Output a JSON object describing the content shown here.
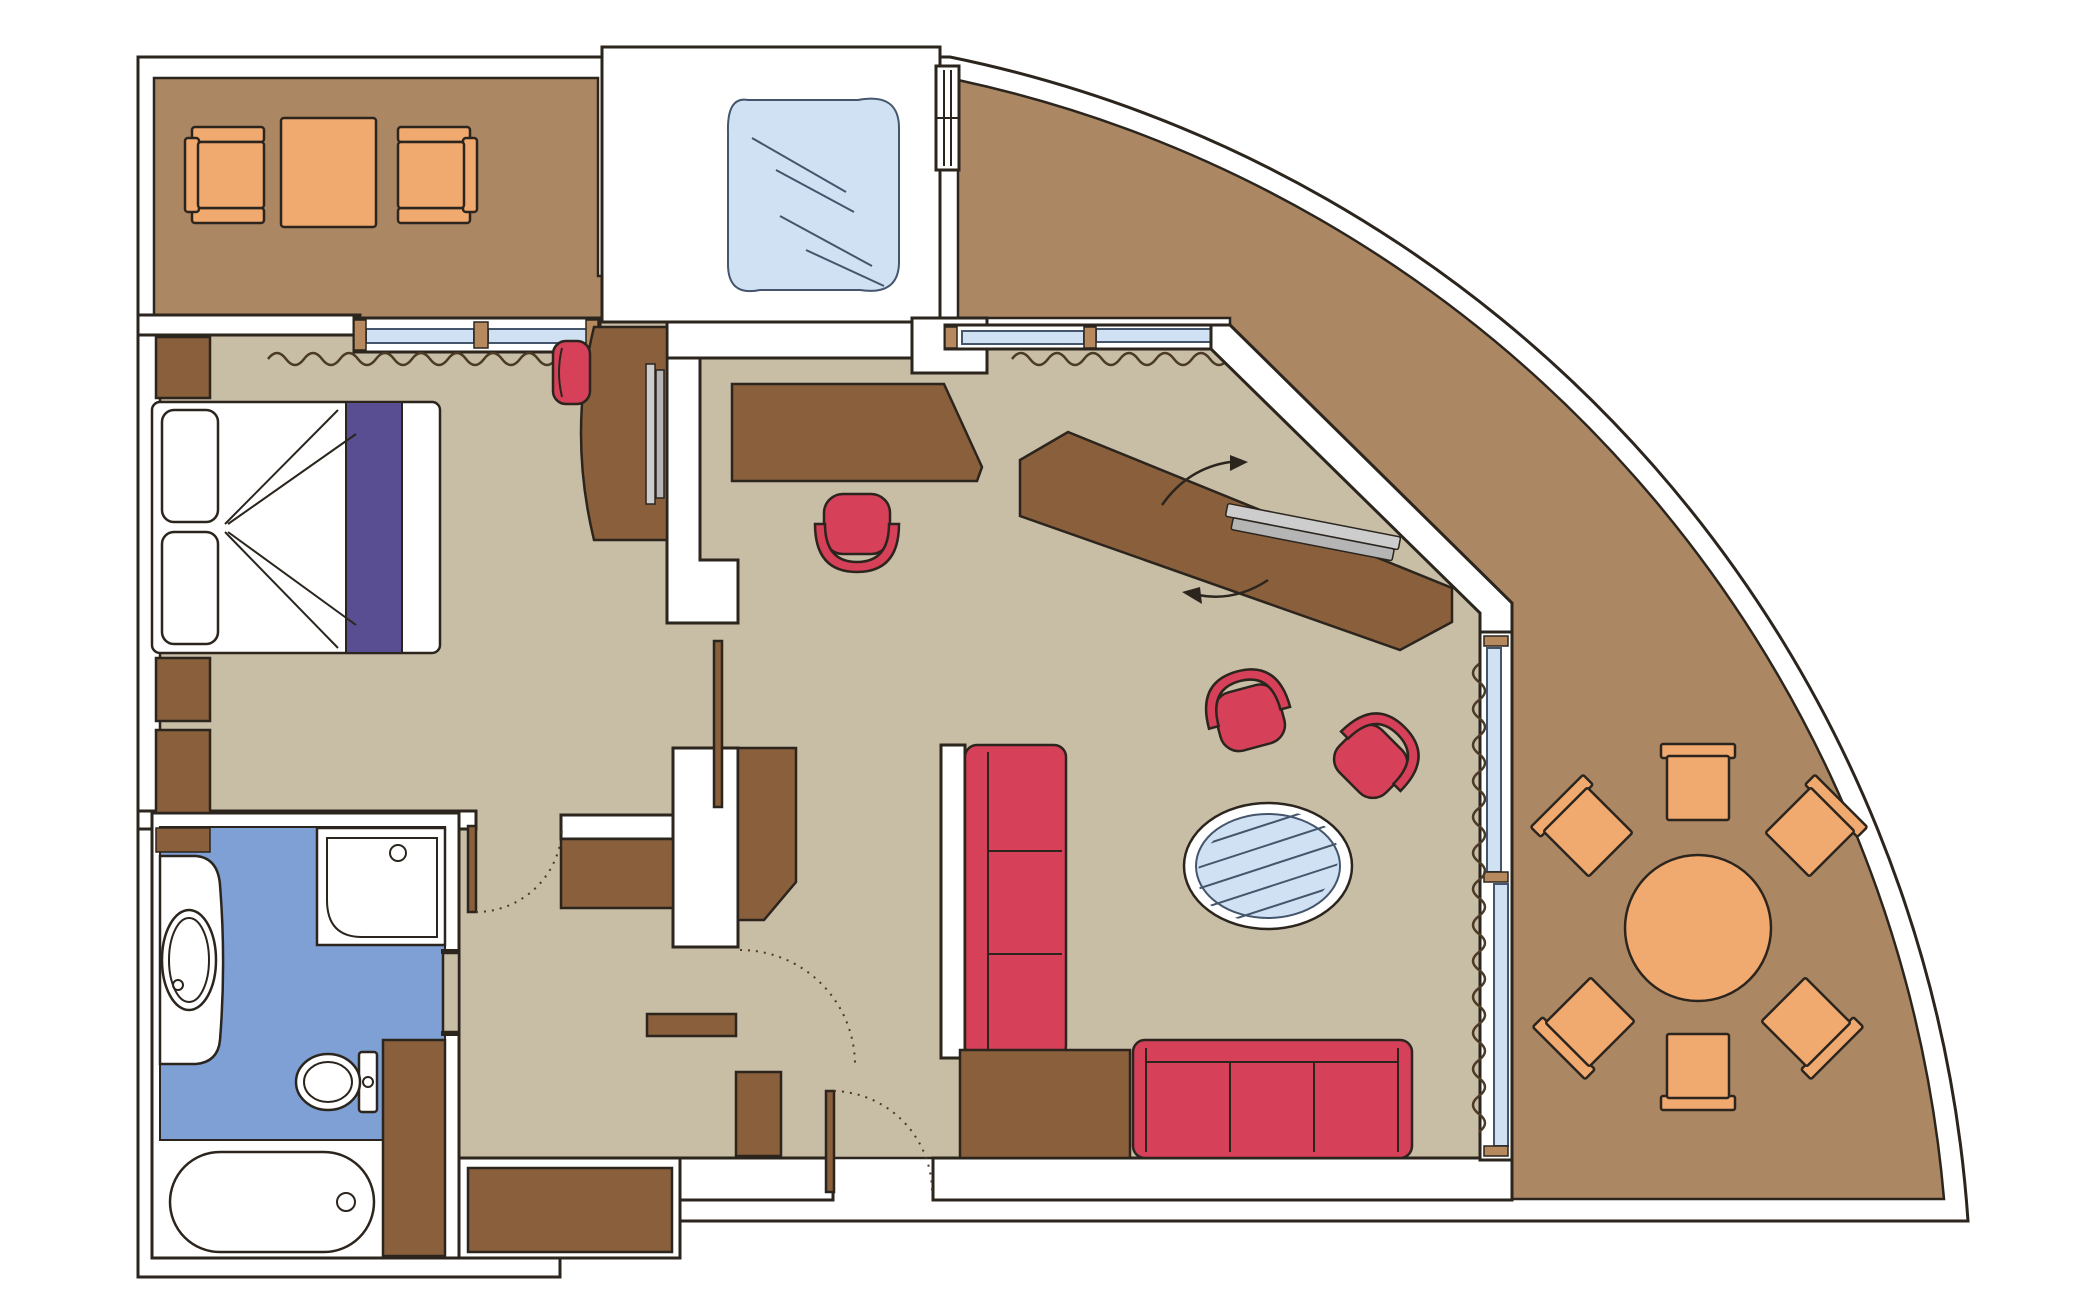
{
  "diagram": {
    "type": "floor-plan",
    "rooms": [
      {
        "name": "private-balcony-top",
        "floor": "balcony",
        "furniture": [
          "armchair",
          "coffee-table",
          "armchair"
        ]
      },
      {
        "name": "shower-room",
        "floor": "white",
        "furniture": [
          "walk-in-glass-shower"
        ]
      },
      {
        "name": "bedroom",
        "floor": "carpet",
        "furniture": [
          "double-bed",
          "pillow",
          "pillow",
          "bed-runner",
          "nightstand",
          "nightstand",
          "nightstand",
          "vanity-desk",
          "tv-panel",
          "vanity-stool",
          "window",
          "window-curtain"
        ]
      },
      {
        "name": "bathroom",
        "floor": "tile-blue",
        "furniture": [
          "vanity-sink",
          "shower-stall",
          "toilet",
          "bathtub",
          "storage-column",
          "corner-shelf",
          "pocket-door"
        ]
      },
      {
        "name": "hallway",
        "floor": "carpet",
        "furniture": [
          "closet",
          "closet",
          "wardrobe",
          "wardrobe",
          "wall-shelf",
          "entry-door",
          "interior-door",
          "bedroom-door"
        ]
      },
      {
        "name": "living-room",
        "floor": "carpet",
        "furniture": [
          "writing-desk",
          "desk-tub-chair",
          "sofa-3-seat-vertical",
          "console-panel",
          "corner-cabinet",
          "sofa-3-seat-horizontal",
          "tub-armchair",
          "tub-armchair",
          "oval-glass-table",
          "swivel-tv-cabinet",
          "flat-tv",
          "window",
          "window-curtain",
          "sliding-glass-balcony-door",
          "door-curtain"
        ]
      },
      {
        "name": "wraparound-balcony",
        "floor": "balcony",
        "furniture": [
          "round-dining-table",
          "dining-chair",
          "dining-chair",
          "dining-chair",
          "dining-chair",
          "dining-chair",
          "dining-chair"
        ]
      }
    ]
  },
  "palette": {
    "background": "#ffffff",
    "wall_fill": "#ffffff",
    "wall_line": "#2b251e",
    "balcony_floor": "#ac8764",
    "room_floor": "#c8bda5",
    "bathroom_floor": "#7ea0d5",
    "wood_furniture": "#8a5f3c",
    "wood_trim": "#b7895f",
    "upholstery_red": "#d64059",
    "upholstery_orange": "#f0aa70",
    "glass_blue": "#cfe1f3",
    "glass_line": "#44556c",
    "bed_runner_purple": "#5a4e92",
    "tv_gray": "#cdcdcd",
    "tv_gray_dark": "#b5b5b5",
    "curtain_line": "#4a3a26"
  }
}
